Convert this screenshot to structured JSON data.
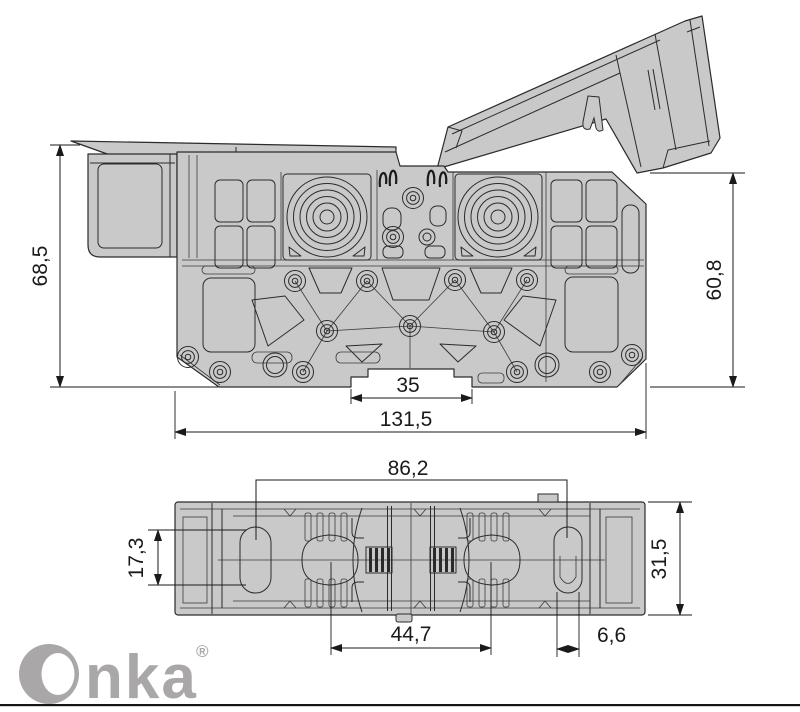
{
  "brand": {
    "wordmark_tail": "nka",
    "registered": "®",
    "color": "#a9a7a8"
  },
  "drawing": {
    "colors": {
      "body_fill": "#c9c9c9",
      "outline": "#2b2b2b",
      "dimension": "#1a1a1a",
      "footer_rule": "#161616"
    },
    "side_view_dimensions": {
      "overall_height_left": "68,5",
      "height_right": "60,8",
      "rail_notch_width": "35",
      "overall_width": "131,5"
    },
    "bottom_view_dimensions": {
      "hole_center_distance": "86,2",
      "left_slot_length": "17,3",
      "overall_depth": "31,5",
      "contact_center_distance": "44,7",
      "slot_width": "6,6"
    }
  }
}
